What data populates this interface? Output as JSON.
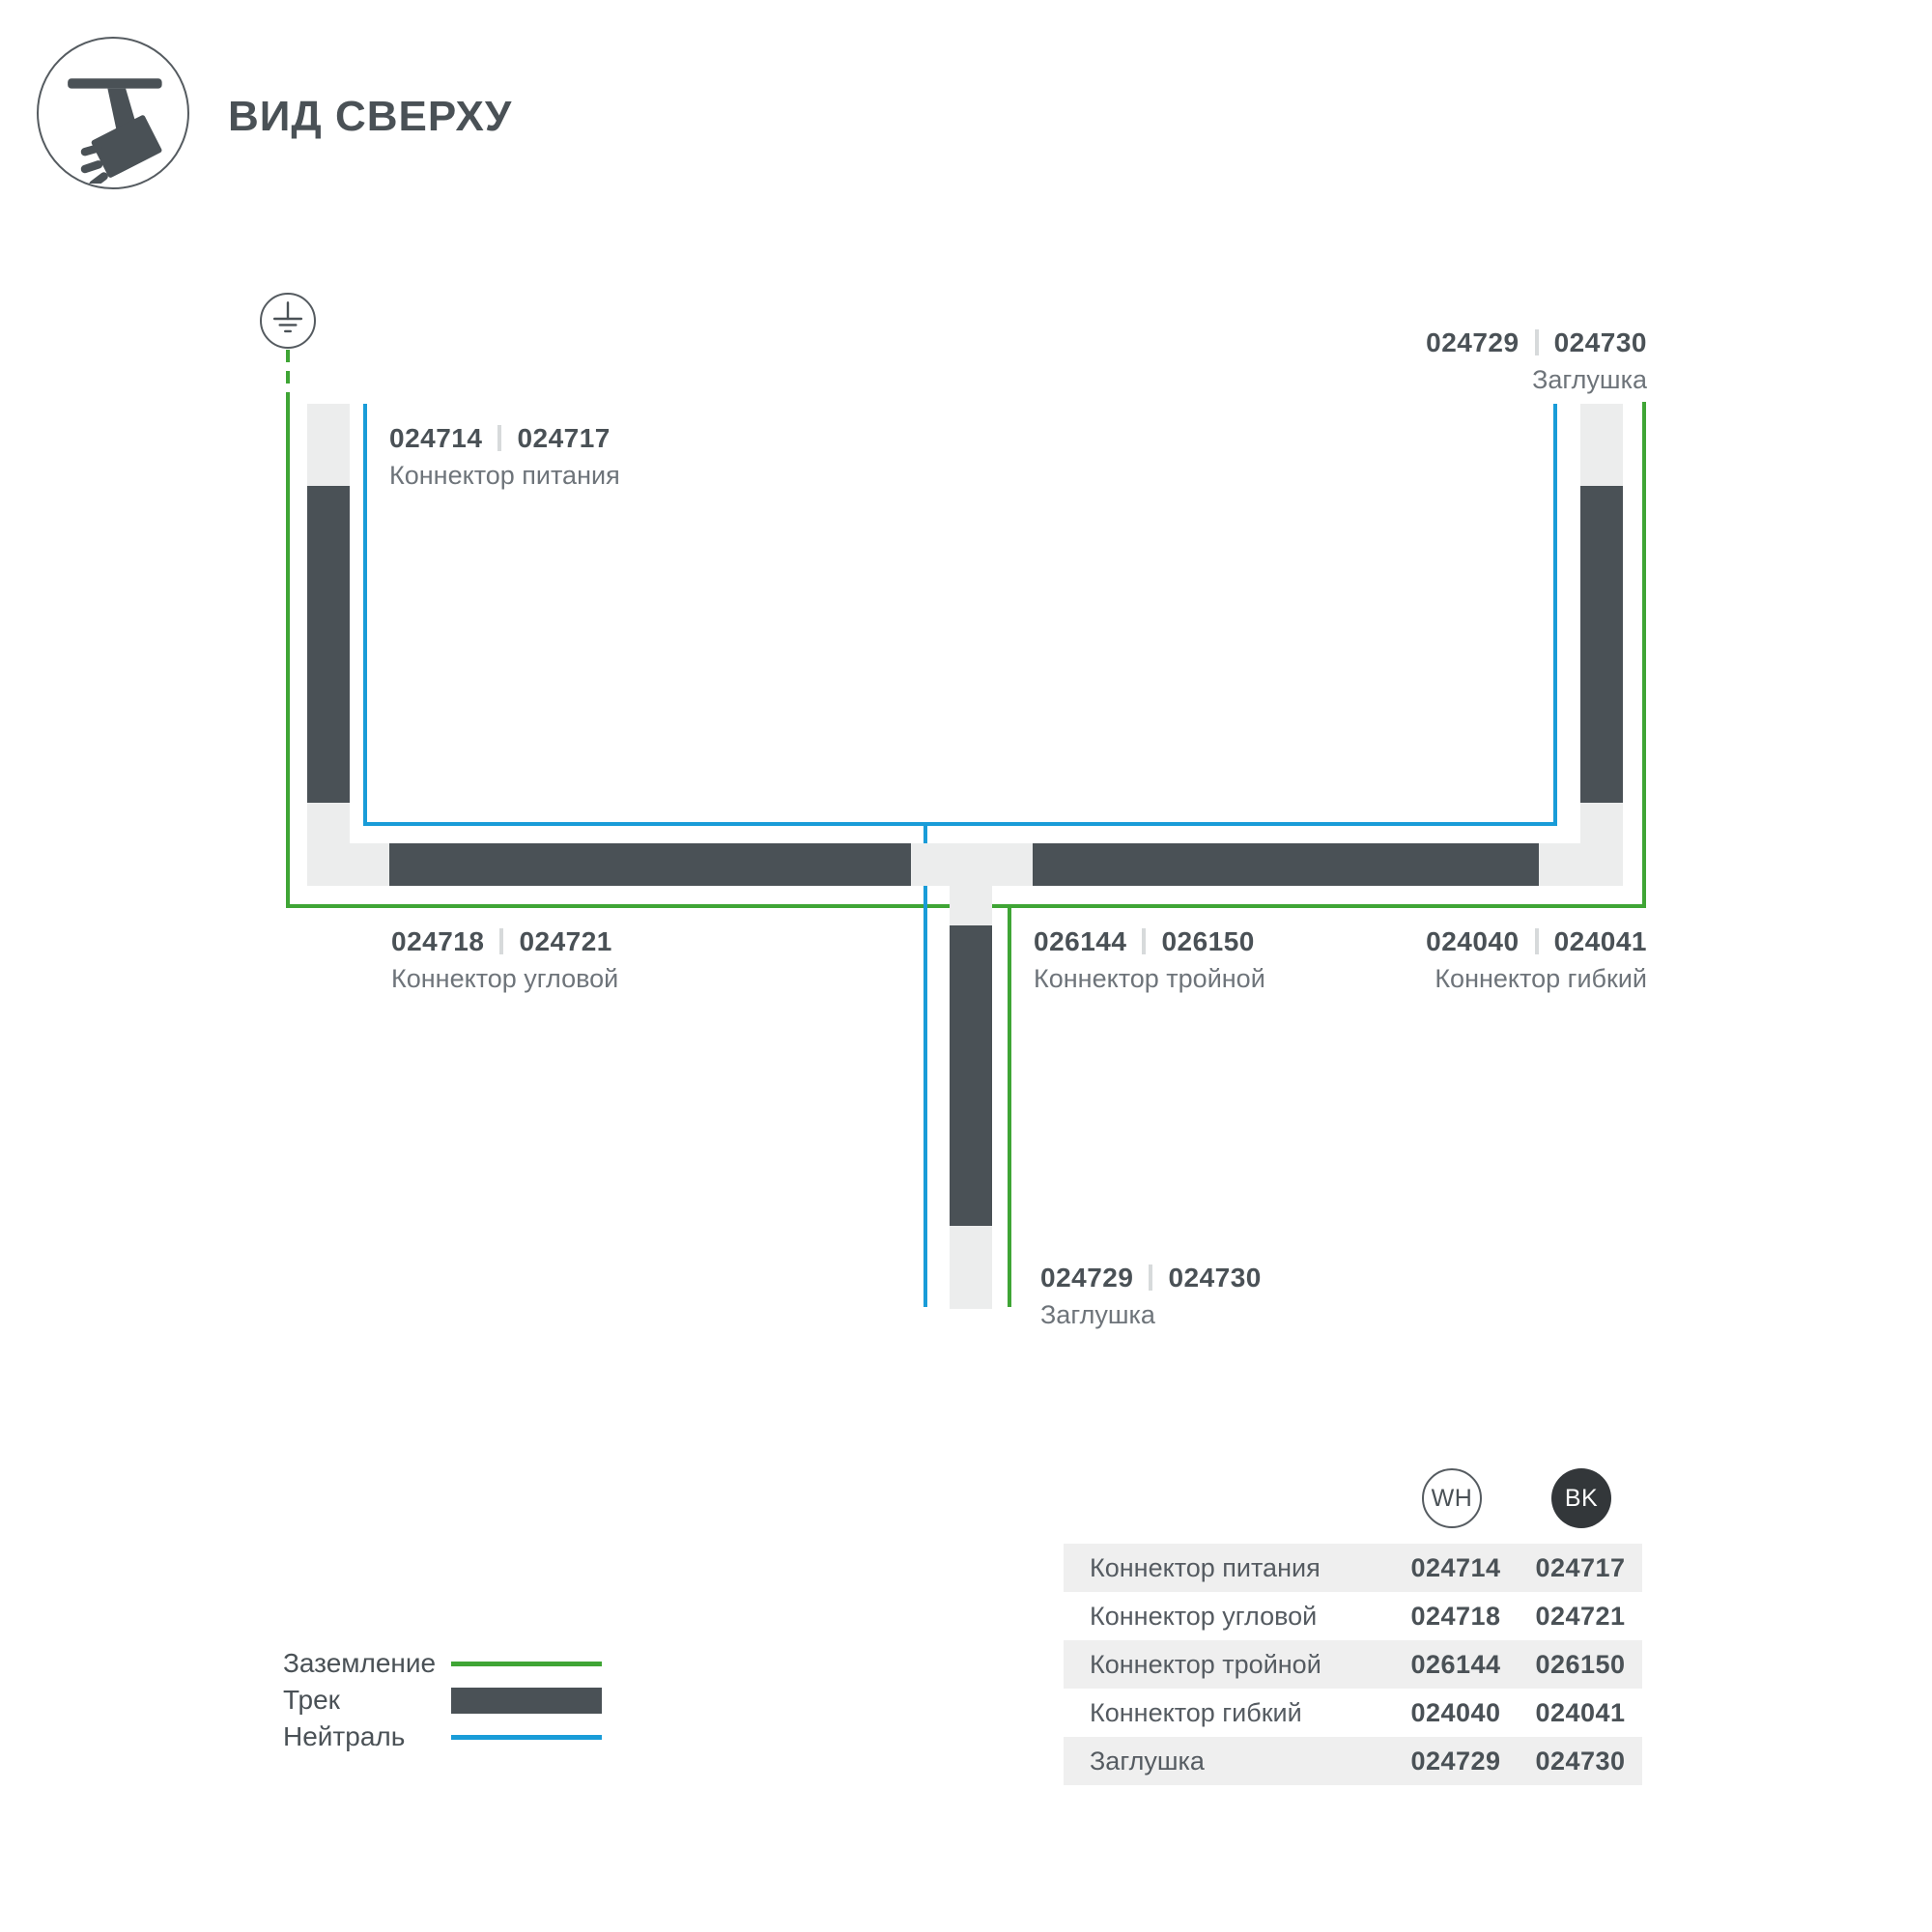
{
  "header": {
    "title": "ВИД СВЕРХУ"
  },
  "icons": {
    "header_icon": "track-light-icon",
    "ground_icon": "ground-earth-icon"
  },
  "colors": {
    "track": "#4A5156",
    "connector": "#ECEDED",
    "ground_green": "#3FA535",
    "neutral_blue": "#199CD8"
  },
  "diagram": {
    "labels": {
      "power": {
        "wh": "024714",
        "bk": "024717",
        "name": "Коннектор питания"
      },
      "endcap_top": {
        "wh": "024729",
        "bk": "024730",
        "name": "Заглушка"
      },
      "corner": {
        "wh": "024718",
        "bk": "024721",
        "name": "Коннектор угловой"
      },
      "triple": {
        "wh": "026144",
        "bk": "026150",
        "name": "Коннектор тройной"
      },
      "flexible": {
        "wh": "024040",
        "bk": "024041",
        "name": "Коннектор гибкий"
      },
      "endcap_bottom": {
        "wh": "024729",
        "bk": "024730",
        "name": "Заглушка"
      }
    }
  },
  "legend": {
    "items": [
      {
        "label": "Заземление",
        "swatch": "ground"
      },
      {
        "label": "Трек",
        "swatch": "track"
      },
      {
        "label": "Нейтраль",
        "swatch": "neutral"
      }
    ]
  },
  "table": {
    "col_wh": "WH",
    "col_bk": "BK",
    "rows": [
      {
        "name": "Коннектор питания",
        "wh": "024714",
        "bk": "024717"
      },
      {
        "name": "Коннектор угловой",
        "wh": "024718",
        "bk": "024721"
      },
      {
        "name": "Коннектор тройной",
        "wh": "026144",
        "bk": "026150"
      },
      {
        "name": "Коннектор гибкий",
        "wh": "024040",
        "bk": "024041"
      },
      {
        "name": "Заглушка",
        "wh": "024729",
        "bk": "024730"
      }
    ]
  }
}
